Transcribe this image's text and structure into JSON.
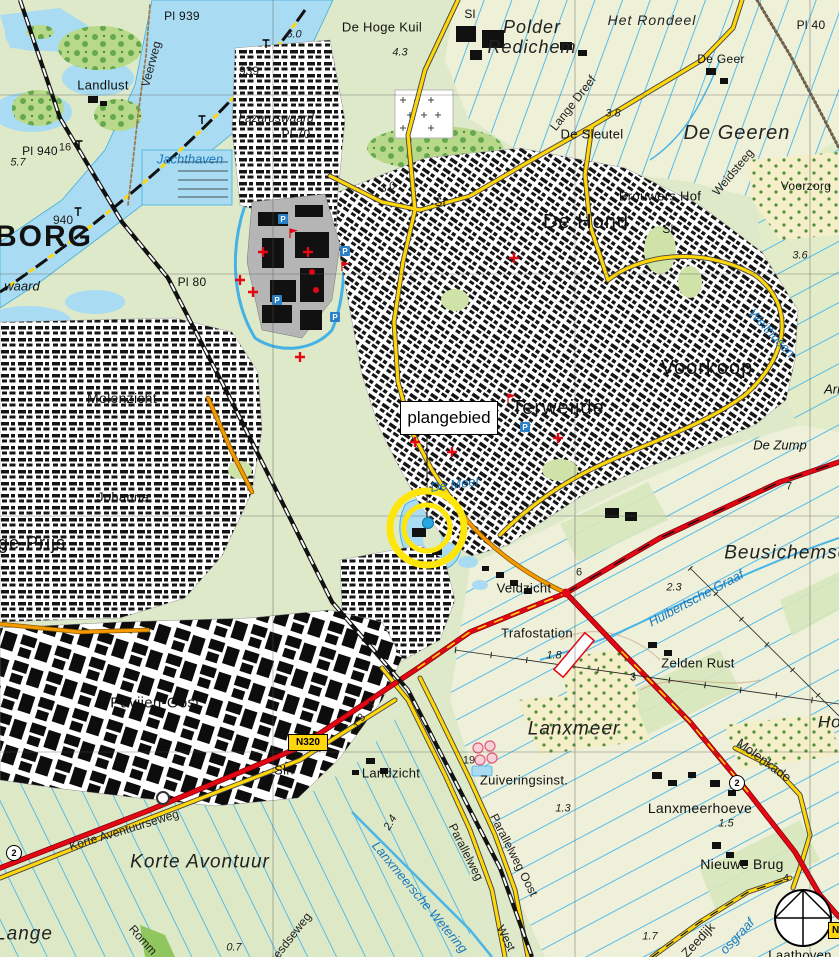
{
  "map": {
    "plangebied": {
      "text": "plangebied"
    },
    "badges": {
      "n320": "N320",
      "n_partial": "N",
      "route2": "2"
    },
    "icons": {
      "parking": "P",
      "compass": "north-compass-rose",
      "highlight": "yellow-circle-marker"
    },
    "colors": {
      "field_green": "#dde9c8",
      "polder_cream": "#eff0d8",
      "water": "#a9dcf2",
      "water_line": "#3eaede",
      "road_yellow": "#ffd60a",
      "road_orange": "#f59b00",
      "road_red": "#e30613",
      "highlight_yellow": "#ffe60a",
      "marker_dot_blue": "#29a8e0",
      "urban_building": "#111111",
      "old_town_gray": "#b5b5b5"
    },
    "labels": [
      {
        "text": "Pl 939",
        "x": 182,
        "y": 16,
        "s": 12,
        "cls": "place"
      },
      {
        "text": "6.0",
        "x": 294,
        "y": 35,
        "s": 11,
        "cls": "numI"
      },
      {
        "text": "De Hoge Kuil",
        "x": 382,
        "y": 27,
        "s": 13,
        "cls": "place"
      },
      {
        "text": "Sl",
        "x": 470,
        "y": 14,
        "s": 12,
        "cls": "place"
      },
      {
        "text": "Polder",
        "x": 532,
        "y": 27,
        "s": 18,
        "cls": "areaI"
      },
      {
        "text": "Redichem",
        "x": 532,
        "y": 47,
        "s": 18,
        "cls": "areaI"
      },
      {
        "text": "Het Rondeel",
        "x": 652,
        "y": 20,
        "s": 14,
        "cls": "areaI"
      },
      {
        "text": "De Geer",
        "x": 721,
        "y": 59,
        "s": 12,
        "cls": "place"
      },
      {
        "text": "Pl 40",
        "x": 811,
        "y": 25,
        "s": 12,
        "cls": "place"
      },
      {
        "text": "Landlust",
        "x": 103,
        "y": 85,
        "s": 13,
        "cls": "place"
      },
      {
        "text": "Veerweg",
        "x": 151,
        "y": 64,
        "s": 12,
        "rot": -75,
        "cls": "road"
      },
      {
        "text": "939",
        "x": 249,
        "y": 71,
        "s": 12,
        "cls": "num"
      },
      {
        "text": "4.3",
        "x": 400,
        "y": 53,
        "s": 11,
        "cls": "numI"
      },
      {
        "text": "3.8",
        "x": 613,
        "y": 114,
        "s": 11,
        "cls": "numI"
      },
      {
        "text": "Lange Dreef",
        "x": 573,
        "y": 103,
        "s": 12,
        "rot": -52,
        "cls": "road"
      },
      {
        "text": "Lazaruswaard",
        "x": 276,
        "y": 118,
        "s": 12,
        "cls": "fieldI"
      },
      {
        "text": "Pl 70",
        "x": 296,
        "y": 134,
        "s": 12,
        "cls": "place"
      },
      {
        "text": "De Sleutel",
        "x": 592,
        "y": 134,
        "s": 13,
        "cls": "place"
      },
      {
        "text": "De Geeren",
        "x": 737,
        "y": 133,
        "s": 20,
        "cls": "areaI"
      },
      {
        "text": "Weidsteeg",
        "x": 733,
        "y": 172,
        "s": 12,
        "rot": -50,
        "cls": "road"
      },
      {
        "text": "Voorzorg",
        "x": 806,
        "y": 186,
        "s": 12,
        "cls": "place"
      },
      {
        "text": "Pl 940",
        "x": 40,
        "y": 151,
        "s": 12,
        "cls": "place"
      },
      {
        "text": "16",
        "x": 65,
        "y": 148,
        "s": 11,
        "cls": "num"
      },
      {
        "text": "5.7",
        "x": 18,
        "y": 163,
        "s": 11,
        "cls": "numI"
      },
      {
        "text": "Jachthaven",
        "x": 190,
        "y": 159,
        "s": 13,
        "cls": "water"
      },
      {
        "text": "Brouwers Hof",
        "x": 660,
        "y": 196,
        "s": 13,
        "cls": "place"
      },
      {
        "text": "De Hond",
        "x": 586,
        "y": 222,
        "s": 20,
        "cls": "big"
      },
      {
        "text": "Sl",
        "x": 668,
        "y": 229,
        "s": 12,
        "cls": "place"
      },
      {
        "text": "3.6",
        "x": 800,
        "y": 256,
        "s": 11,
        "cls": "numI"
      },
      {
        "text": "940",
        "x": 63,
        "y": 220,
        "s": 12,
        "cls": "num"
      },
      {
        "text": "BORG",
        "x": 44,
        "y": 237,
        "s": 30,
        "cls": "city"
      },
      {
        "text": "waard",
        "x": 22,
        "y": 286,
        "s": 13,
        "cls": "fieldI"
      },
      {
        "text": "Pl 80",
        "x": 192,
        "y": 282,
        "s": 12,
        "cls": "place"
      },
      {
        "text": "3.0",
        "x": 388,
        "y": 188,
        "s": 11,
        "rot": -15,
        "cls": "numI"
      },
      {
        "text": "Sl",
        "x": 440,
        "y": 202,
        "s": 12,
        "cls": "place"
      },
      {
        "text": "Molenzicht",
        "x": 122,
        "y": 398,
        "s": 14,
        "cls": "place"
      },
      {
        "text": "Johanna",
        "x": 123,
        "y": 497,
        "s": 13,
        "cls": "place"
      },
      {
        "text": "ge Prijs",
        "x": 32,
        "y": 543,
        "s": 18,
        "cls": "big"
      },
      {
        "text": "Terweijde",
        "x": 558,
        "y": 408,
        "s": 20,
        "cls": "big"
      },
      {
        "text": "Voorkoop",
        "x": 707,
        "y": 368,
        "s": 20,
        "cls": "big"
      },
      {
        "text": "Weithusen",
        "x": 772,
        "y": 333,
        "s": 13,
        "rot": 47,
        "cls": "water"
      },
      {
        "text": "De Zump",
        "x": 780,
        "y": 445,
        "s": 13,
        "cls": "fieldI"
      },
      {
        "text": "Arm",
        "x": 836,
        "y": 389,
        "s": 13,
        "cls": "fieldI"
      },
      {
        "text": "De Meer",
        "x": 455,
        "y": 484,
        "s": 13,
        "rot": -8,
        "cls": "water"
      },
      {
        "text": "7",
        "x": 789,
        "y": 487,
        "s": 11,
        "cls": "num"
      },
      {
        "text": "Beusichemsch",
        "x": 792,
        "y": 553,
        "s": 19,
        "cls": "areaI"
      },
      {
        "text": "2.3",
        "x": 674,
        "y": 588,
        "s": 11,
        "cls": "numI"
      },
      {
        "text": "Huibertsche Graaf",
        "x": 696,
        "y": 598,
        "s": 13,
        "rot": -28,
        "cls": "water"
      },
      {
        "text": "Veldzicht",
        "x": 524,
        "y": 588,
        "s": 13,
        "cls": "place"
      },
      {
        "text": "6",
        "x": 579,
        "y": 573,
        "s": 11,
        "cls": "num"
      },
      {
        "text": "Trafostation",
        "x": 537,
        "y": 633,
        "s": 13,
        "cls": "place"
      },
      {
        "text": "1.8",
        "x": 554,
        "y": 656,
        "s": 11,
        "cls": "numI"
      },
      {
        "text": "Zelden Rust",
        "x": 698,
        "y": 663,
        "s": 13,
        "cls": "place"
      },
      {
        "text": "3",
        "x": 633,
        "y": 678,
        "s": 11,
        "cls": "num"
      },
      {
        "text": "Hoe",
        "x": 835,
        "y": 722,
        "s": 17,
        "cls": "areaI"
      },
      {
        "text": "Pavijen-Oost",
        "x": 155,
        "y": 703,
        "s": 15,
        "cls": "place"
      },
      {
        "text": "Sln",
        "x": 284,
        "y": 770,
        "s": 13,
        "cls": "place"
      },
      {
        "text": "5",
        "x": 371,
        "y": 706,
        "s": 11,
        "cls": "num"
      },
      {
        "text": "1.3",
        "x": 360,
        "y": 722,
        "s": 11,
        "rot": -60,
        "cls": "numI"
      },
      {
        "text": "Landzicht",
        "x": 391,
        "y": 773,
        "s": 13,
        "cls": "place"
      },
      {
        "text": "19",
        "x": 469,
        "y": 761,
        "s": 11,
        "cls": "num"
      },
      {
        "text": "Zuiveringsinst.",
        "x": 524,
        "y": 780,
        "s": 13,
        "cls": "place"
      },
      {
        "text": "Lanxmeer",
        "x": 574,
        "y": 729,
        "s": 19,
        "cls": "areaI"
      },
      {
        "text": "Molenkade",
        "x": 764,
        "y": 760,
        "s": 13,
        "rot": 36,
        "cls": "road"
      },
      {
        "text": "Lanxmeerhoeve",
        "x": 700,
        "y": 808,
        "s": 14,
        "cls": "place"
      },
      {
        "text": "1.5",
        "x": 726,
        "y": 824,
        "s": 11,
        "cls": "numI"
      },
      {
        "text": "Nieuwe Brug",
        "x": 742,
        "y": 864,
        "s": 14,
        "cls": "place"
      },
      {
        "text": "4",
        "x": 786,
        "y": 879,
        "s": 11,
        "cls": "num"
      },
      {
        "text": "Korte Aventuurseweg",
        "x": 124,
        "y": 830,
        "s": 12,
        "rot": -17,
        "cls": "road"
      },
      {
        "text": "Korte Avontuur",
        "x": 200,
        "y": 862,
        "s": 19,
        "cls": "areaI"
      },
      {
        "text": "Lange",
        "x": 24,
        "y": 934,
        "s": 19,
        "cls": "areaI"
      },
      {
        "text": "Romm",
        "x": 143,
        "y": 940,
        "s": 12,
        "rot": 48,
        "cls": "road"
      },
      {
        "text": "eesdseweg",
        "x": 290,
        "y": 938,
        "s": 12,
        "rot": -52,
        "cls": "road"
      },
      {
        "text": "0.7",
        "x": 234,
        "y": 948,
        "s": 11,
        "cls": "numI"
      },
      {
        "text": "2.4",
        "x": 391,
        "y": 823,
        "s": 11,
        "rot": -60,
        "cls": "numI"
      },
      {
        "text": "Parallelweg",
        "x": 466,
        "y": 852,
        "s": 12,
        "rot": 63,
        "cls": "road"
      },
      {
        "text": "West",
        "x": 506,
        "y": 938,
        "s": 12,
        "rot": 63,
        "cls": "road"
      },
      {
        "text": "Parallelweg Oost",
        "x": 514,
        "y": 855,
        "s": 12,
        "rot": 63,
        "cls": "road"
      },
      {
        "text": "Lanxmeersche Wetering",
        "x": 420,
        "y": 897,
        "s": 13,
        "rot": 50,
        "cls": "water"
      },
      {
        "text": "1.3",
        "x": 563,
        "y": 809,
        "s": 11,
        "cls": "numI"
      },
      {
        "text": "Zeedijk",
        "x": 698,
        "y": 940,
        "s": 13,
        "rot": -47,
        "cls": "road"
      },
      {
        "text": "osgraaf",
        "x": 737,
        "y": 936,
        "s": 13,
        "rot": -47,
        "cls": "water"
      },
      {
        "text": "1.7",
        "x": 650,
        "y": 937,
        "s": 11,
        "cls": "numI"
      },
      {
        "text": "Laathoven",
        "x": 800,
        "y": 955,
        "s": 13,
        "cls": "place"
      }
    ]
  }
}
